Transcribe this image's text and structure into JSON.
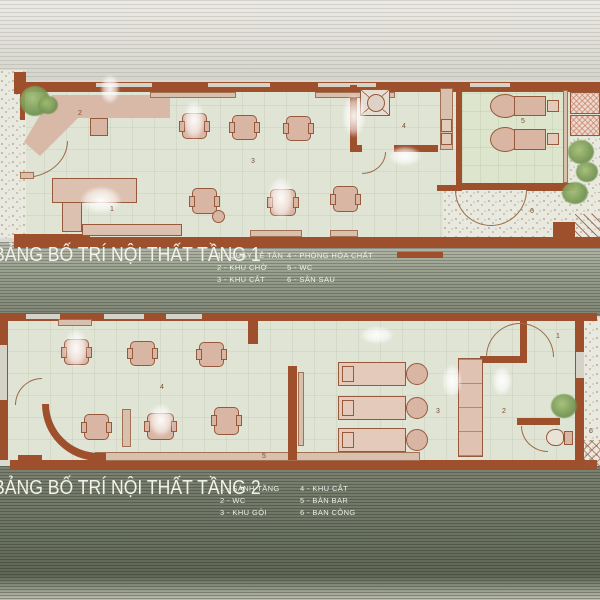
{
  "floor1": {
    "title": "BẢNG BỐ TRÍ NỘI THẤT TẦNG 1",
    "legend_col1": [
      "1 - QUẦY LỄ TÂN",
      "2 - KHU CHỜ",
      "3 - KHU CẮT"
    ],
    "legend_col2": [
      "4 - PHÒNG HÓA CHẤT",
      "5 - WC",
      "6 - SÂN SAU"
    ],
    "room_labels": {
      "reception": "1",
      "waiting": "2",
      "cutting": "3",
      "chemical": "4",
      "wc": "5",
      "backyard": "6"
    }
  },
  "floor2": {
    "title": "BẢNG BỐ TRÍ NỘI THẤT TẦNG 2",
    "legend_col1": [
      "1 - SẢNH TẦNG",
      "2 - WC",
      "3 - KHU GỘI"
    ],
    "legend_col2": [
      "4 - KHU CẮT",
      "5 - BÀN BAR",
      "6 - BAN CÔNG"
    ],
    "room_labels": {
      "lobby": "1",
      "wc": "2",
      "washing": "3",
      "cutting": "4",
      "bar": "5",
      "balcony": "6"
    }
  },
  "colors": {
    "wall": "#9e4f2c",
    "floor": "#e0e4d5",
    "floor_green": "#dde6cc",
    "furniture": "#d9b6a4",
    "furniture_light": "#e4cabb",
    "outline": "#96593c",
    "speckle_base": "#eae9df",
    "plant_green": "#7fa05f",
    "background_top": "#d9d8d1",
    "background_mid": "#8b9181",
    "background_bottom": "#6e7565",
    "title_text": "#f2f1ea"
  }
}
